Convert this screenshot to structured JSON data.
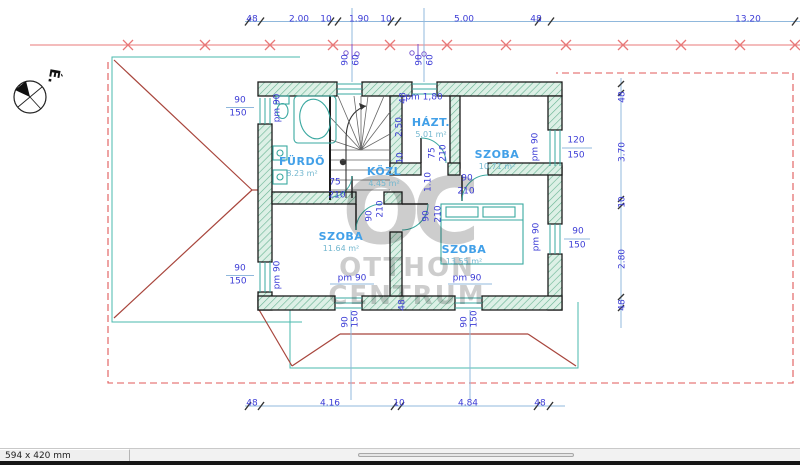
{
  "statusbar": {
    "page_size": "594 x 420 mm"
  },
  "compass": {
    "label": "É."
  },
  "watermark": {
    "logo": "OC",
    "line1": "OTTHON",
    "line2": "CENTRUM"
  },
  "colors": {
    "dimension_text": "#3c3cd6",
    "dimension_line": "#90b8dc",
    "section_line_red": "#e87878",
    "roof_red": "#a8453c",
    "fixture_teal": "#3aa8a0",
    "wall_hatch_green": "#66b392",
    "room_name_blue": "#42a0e8",
    "watermark_grey": "#8f8f8f"
  },
  "rooms": [
    {
      "name": "FÜRDŐ",
      "area": "8.23 m²",
      "x": 302,
      "y": 156
    },
    {
      "name": "HÁZT.",
      "area": "5.01 m²",
      "x": 431,
      "y": 117
    },
    {
      "name": "SZOBA",
      "area": "10.71 m²",
      "x": 497,
      "y": 149
    },
    {
      "name": "KÖZL",
      "area": "4.45 m²",
      "x": 384,
      "y": 166
    },
    {
      "name": "SZOBA",
      "area": "11.64 m²",
      "x": 341,
      "y": 231
    },
    {
      "name": "SZOBA",
      "area": "13.55 m²",
      "x": 464,
      "y": 244
    }
  ],
  "annotations": [
    {
      "t": "48",
      "x": 252,
      "y": 20
    },
    {
      "t": "2.00",
      "x": 299,
      "y": 20
    },
    {
      "t": "10",
      "x": 326,
      "y": 20
    },
    {
      "t": "1.90",
      "x": 359,
      "y": 20
    },
    {
      "t": "10",
      "x": 386,
      "y": 20
    },
    {
      "t": "5.00",
      "x": 464,
      "y": 20
    },
    {
      "t": "48",
      "x": 536,
      "y": 20
    },
    {
      "t": "13.20",
      "x": 748,
      "y": 20
    },
    {
      "t": "48",
      "x": 252,
      "y": 404
    },
    {
      "t": "4.16",
      "x": 330,
      "y": 404
    },
    {
      "t": "10",
      "x": 399,
      "y": 404
    },
    {
      "t": "4.84",
      "x": 468,
      "y": 404
    },
    {
      "t": "48",
      "x": 540,
      "y": 404
    },
    {
      "t": "48",
      "x": 623,
      "y": 97,
      "r": 1
    },
    {
      "t": "3.70",
      "x": 623,
      "y": 152,
      "r": 1
    },
    {
      "t": "10",
      "x": 623,
      "y": 202,
      "r": 1
    },
    {
      "t": "2.80",
      "x": 623,
      "y": 259,
      "r": 1
    },
    {
      "t": "48",
      "x": 623,
      "y": 305,
      "r": 1
    },
    {
      "t": "90",
      "x": 240,
      "y": 101
    },
    {
      "t": "150",
      "x": 238,
      "y": 114
    },
    {
      "t": "90",
      "x": 240,
      "y": 269
    },
    {
      "t": "150",
      "x": 238,
      "y": 282
    },
    {
      "t": "120",
      "x": 576,
      "y": 141
    },
    {
      "t": "150",
      "x": 576,
      "y": 156
    },
    {
      "t": "90",
      "x": 578,
      "y": 232
    },
    {
      "t": "150",
      "x": 577,
      "y": 246
    },
    {
      "t": "90",
      "x": 346,
      "y": 60,
      "r": 1
    },
    {
      "t": "60",
      "x": 357,
      "y": 60,
      "r": 1
    },
    {
      "t": "90",
      "x": 420,
      "y": 60,
      "r": 1
    },
    {
      "t": "60",
      "x": 431,
      "y": 60,
      "r": 1
    },
    {
      "t": "pm 90",
      "x": 278,
      "y": 108,
      "r": 1
    },
    {
      "t": "pm 90",
      "x": 278,
      "y": 275,
      "r": 1
    },
    {
      "t": "pm 90",
      "x": 536,
      "y": 147,
      "r": 1
    },
    {
      "t": "pm 90",
      "x": 537,
      "y": 237,
      "r": 1
    },
    {
      "t": "pm 90",
      "x": 352,
      "y": 279
    },
    {
      "t": "pm 90",
      "x": 467,
      "y": 279
    },
    {
      "t": "pm 1,80",
      "x": 424,
      "y": 98
    },
    {
      "t": "48",
      "x": 404,
      "y": 98,
      "r": 1
    },
    {
      "t": "2.50",
      "x": 400,
      "y": 127,
      "r": 1
    },
    {
      "t": "10",
      "x": 401,
      "y": 158,
      "r": 1
    },
    {
      "t": "1.10",
      "x": 429,
      "y": 182,
      "r": 1
    },
    {
      "t": "48",
      "x": 403,
      "y": 305,
      "r": 1
    },
    {
      "t": "90",
      "x": 346,
      "y": 322,
      "r": 1
    },
    {
      "t": "150",
      "x": 356,
      "y": 319,
      "r": 1
    },
    {
      "t": "90",
      "x": 465,
      "y": 322,
      "r": 1
    },
    {
      "t": "150",
      "x": 475,
      "y": 319,
      "r": 1
    },
    {
      "t": "75",
      "x": 335,
      "y": 183
    },
    {
      "t": "210",
      "x": 337,
      "y": 196
    },
    {
      "t": "75",
      "x": 433,
      "y": 153,
      "r": 1
    },
    {
      "t": "210",
      "x": 444,
      "y": 153,
      "r": 1
    },
    {
      "t": "90",
      "x": 467,
      "y": 179
    },
    {
      "t": "210",
      "x": 466,
      "y": 192
    },
    {
      "t": "90",
      "x": 370,
      "y": 216,
      "r": 1
    },
    {
      "t": "210",
      "x": 381,
      "y": 209,
      "r": 1
    },
    {
      "t": "90",
      "x": 427,
      "y": 216,
      "r": 1
    },
    {
      "t": "210",
      "x": 439,
      "y": 214,
      "r": 1
    }
  ]
}
